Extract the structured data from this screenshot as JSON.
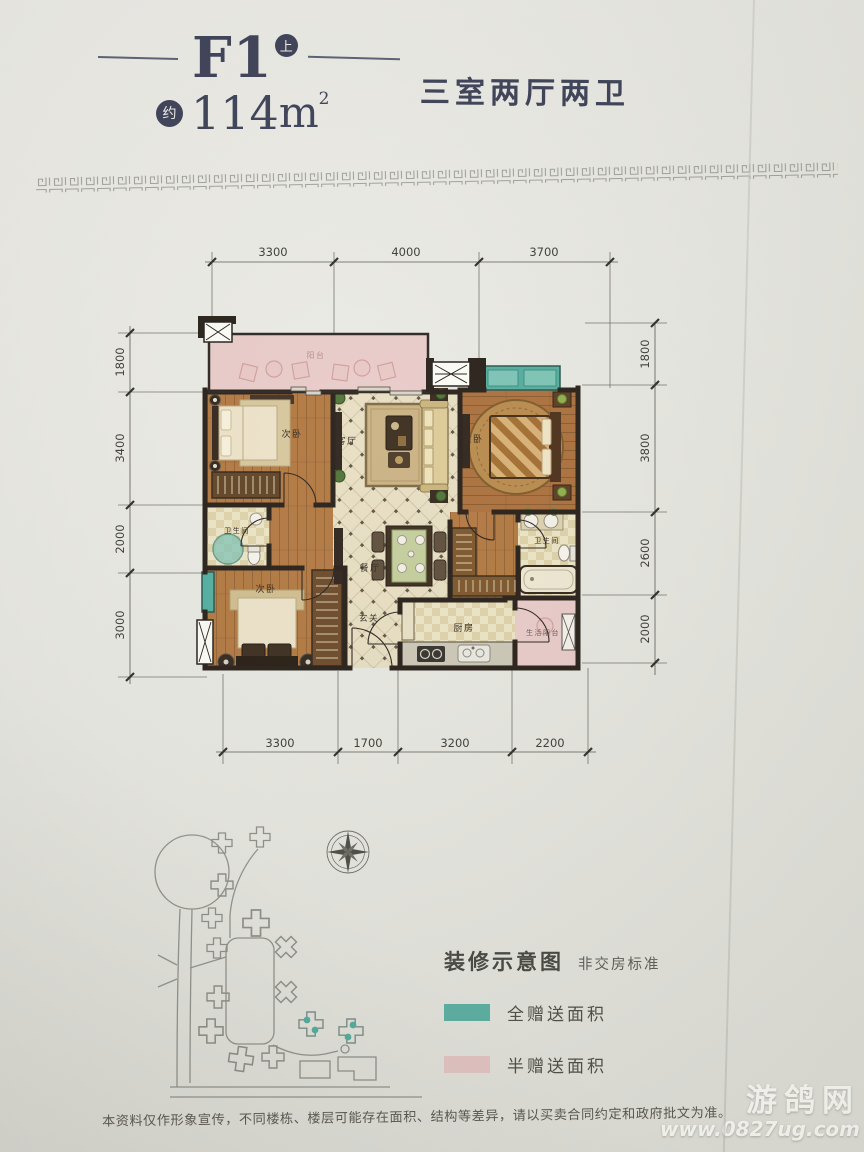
{
  "header": {
    "code": "F1",
    "floor_badge": "上",
    "approx": "约",
    "area": "114",
    "unit": "m",
    "sup": "2",
    "type": "三室两厅两卫"
  },
  "dims": {
    "top": [
      "3300",
      "4000",
      "3700"
    ],
    "bottom": [
      "3300",
      "1700",
      "3200",
      "2200"
    ],
    "left": [
      "1800",
      "3400",
      "2000",
      "3000"
    ],
    "right": [
      "1800",
      "3800",
      "2600",
      "2000"
    ]
  },
  "rooms": {
    "balcony": "阳台",
    "bedroom_top": "次卧",
    "living": "客厅",
    "master": "主卧",
    "bath_left": "卫生间",
    "dining": "餐厅",
    "bedroom_bottom": "次卧",
    "foyer": "玄关",
    "kitchen": "厨房",
    "bath_right": "卫生间",
    "service_balcony": "生活阳台"
  },
  "legend": {
    "title": "装修示意图",
    "subtitle": "非交房标准",
    "items": [
      {
        "label": "全赠送面积",
        "color": "#57b0a2"
      },
      {
        "label": "半赠送面积",
        "color": "#e6c6c4"
      }
    ]
  },
  "disclaimer": "本资料仅作形象宣传，不同楼栋、楼层可能存在面积、结构等差异，请以买卖合同约定和政府批文为准。",
  "watermark": {
    "name": "游鸽网",
    "url": "www.0827ug.com"
  }
}
